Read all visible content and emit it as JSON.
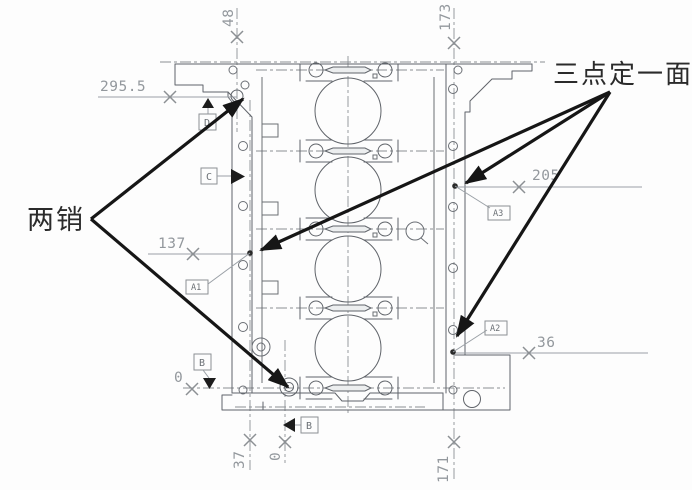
{
  "drawing": {
    "description": "engine-block-fixture-locating-scheme",
    "annotations": {
      "two_pins_label": "两销",
      "three_points_label": "三点定一面"
    },
    "dimensions": {
      "left_top": "295.5",
      "top_left_vertical": "48",
      "top_right_vertical": "173",
      "mid_left": "137",
      "right_upper": "205",
      "right_lower": "36",
      "bottom_left_zero": "0",
      "bottom_first": "37",
      "bottom_second_zero": "0",
      "bottom_right": "171"
    },
    "datum_labels": {
      "d_upper_left": "D",
      "c_left": "C",
      "a1": "A1",
      "b_left": "B",
      "b_bottom": "B",
      "a3": "A3",
      "a2": "A2"
    },
    "colors": {
      "background": "#fdfdfd",
      "drawing_line": "#60646a",
      "dimension": "#93989d",
      "annotation": "#161616"
    }
  }
}
